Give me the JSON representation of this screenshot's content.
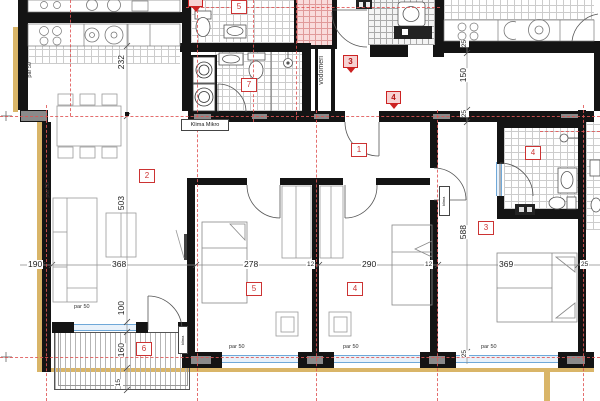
{
  "title": "apartment-floor-plan",
  "labels": {
    "r1": "1",
    "r2": "2",
    "r3": "3",
    "r4": "4",
    "r5": "5",
    "r6": "6",
    "r7": "7",
    "upper5": "5",
    "bath4": "4",
    "shield3": "3",
    "shield4": "4",
    "shield_partial": ""
  },
  "t": {
    "d232": "232",
    "d503": "503",
    "d100": "100",
    "d160": "160",
    "d15": "15",
    "d190": "190",
    "d368": "368",
    "d278": "278",
    "d290": "290",
    "d369": "369",
    "d12": "12",
    "d25": "25",
    "d150": "150",
    "d588": "588",
    "par50": "par 50",
    "vodomeri": "vodomeri",
    "klima_mikro": "Klima Mikro",
    "mini_label": "klima"
  },
  "colors": {
    "wall": "#141414",
    "pier": "#8a8a8a",
    "insulation_tan": "#d9b568",
    "axis_red": "#e05555",
    "label_red": "#cc3333",
    "window_blue": "#6fa8d8",
    "tile_grout": "#cccccc",
    "tile_pink": "#e09a9a"
  },
  "icons": [
    "stove-burners-icon",
    "kitchen-sink-icon",
    "washing-machine-icon",
    "toilet-icon",
    "washbasin-icon",
    "shower-head-icon",
    "boiler-icon",
    "bed-icon",
    "sofa-icon",
    "dining-table-icon",
    "wardrobe-icon",
    "door-swing-icon",
    "axis-cross-marker-icon"
  ]
}
